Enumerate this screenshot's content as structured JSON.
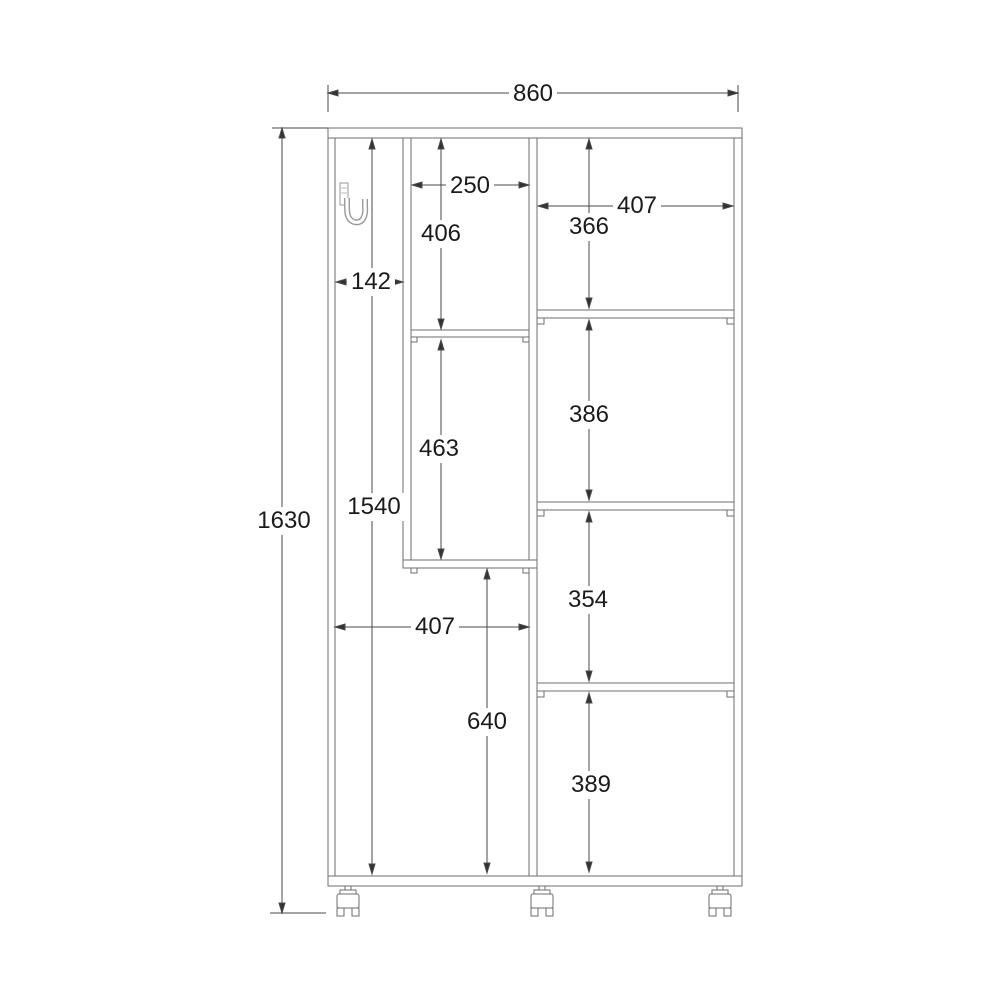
{
  "drawing": {
    "type": "cabinet-front-elevation-dimension-drawing",
    "components": {
      "hook_icon": "coat-hook",
      "caster_icon": "swivel-caster",
      "caster_count": 3
    },
    "colors": {
      "background": "#ffffff",
      "structure_line": "#6e6e6e",
      "dimension_line": "#4a4a4a",
      "text": "#1b1b1b"
    }
  },
  "dimensions": {
    "overall_width": "860",
    "overall_height": "1630",
    "interior_height": "1540",
    "left_section_width": "142",
    "cubby_width": "250",
    "cubby_upper_height": "406",
    "cubby_lower_height": "463",
    "lower_open_width": "407",
    "lower_open_height": "640",
    "right_section_width": "407",
    "right_shelf_1_height": "366",
    "right_shelf_2_height": "386",
    "right_shelf_3_height": "354",
    "right_shelf_4_height": "389"
  }
}
